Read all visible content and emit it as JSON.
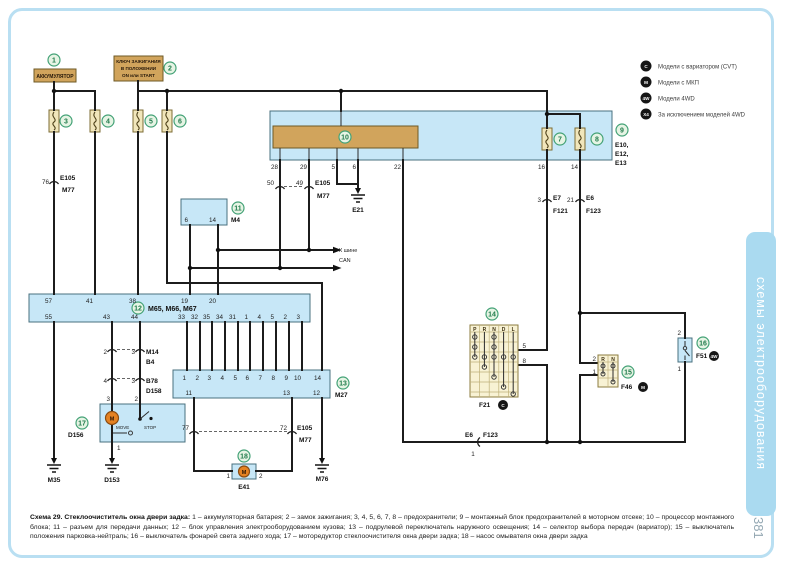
{
  "page": {
    "side_tab": "схемы электрооборудования",
    "number": "381"
  },
  "legend": {
    "items": [
      {
        "badge": "C",
        "text": "Модели с вариатором (CVT)"
      },
      {
        "badge": "M",
        "text": "Модели с МКП"
      },
      {
        "badge": "4W",
        "text": "Модели 4WD"
      },
      {
        "badge": "X4",
        "text": "За исключением моделей 4WD"
      }
    ]
  },
  "nums": {
    "n1": "1",
    "n2": "2",
    "n3": "3",
    "n4": "4",
    "n5": "5",
    "n6": "6",
    "n7": "7",
    "n8": "8",
    "n9": "9",
    "n10": "10",
    "n11": "11",
    "n12": "12",
    "n13": "13",
    "n14": "14",
    "n15": "15",
    "n16": "16",
    "n17": "17",
    "n18": "18"
  },
  "battery": {
    "label": "АККУМУЛЯТОР"
  },
  "ignition": {
    "l1": "КЛЮЧ ЗАЖИГАНИЯ",
    "l2": "В ПОЛОЖЕНИИ",
    "l3": "ON или START"
  },
  "box9": {
    "pins": [
      "28",
      "29",
      "5",
      "6",
      "22",
      "16",
      "14"
    ],
    "codes": [
      "E10,",
      "E12,",
      "E13"
    ]
  },
  "conn76": {
    "pin": "76",
    "a": "E105",
    "b": "M77"
  },
  "conn50": {
    "l": "50",
    "r": "49",
    "a": "E105",
    "b": "M77"
  },
  "connE7": {
    "pin": "3",
    "a": "E7",
    "b": "F121"
  },
  "connE6": {
    "pin": "21",
    "a": "E6",
    "b": "F123"
  },
  "grounds": {
    "e21": "E21",
    "m35": "M35",
    "d153": "D153",
    "m76": "M76"
  },
  "box11": {
    "label": "M4",
    "p1": "6",
    "p2": "14"
  },
  "can": {
    "l1": "К шине",
    "l2": "CAN"
  },
  "box12": {
    "label": "M65, M66, M67",
    "top": [
      "57",
      "41",
      "38",
      "19",
      "20"
    ],
    "bottom": [
      "55",
      "43",
      "44",
      "33",
      "32",
      "35",
      "34",
      "31",
      "1",
      "4",
      "5",
      "2",
      "3"
    ]
  },
  "connM14": {
    "l": "2",
    "r": "3",
    "a": "M14",
    "b": "B4"
  },
  "connB78": {
    "l": "4",
    "r": "3",
    "a": "B78",
    "b": "D158"
  },
  "box17": {
    "label": "D156",
    "p3": "3",
    "p2": "2",
    "p1": "1",
    "move": "MOVE",
    "stop": "STOP",
    "m": "M"
  },
  "box13": {
    "label": "M27",
    "top": [
      "1",
      "2",
      "3",
      "4",
      "5",
      "6",
      "7",
      "8",
      "9",
      "10",
      "14"
    ],
    "bottom": [
      "11",
      "13",
      "12"
    ]
  },
  "conn77": {
    "l": "77",
    "r": "72",
    "a": "E105",
    "b": "M77"
  },
  "motor18": {
    "label": "E41",
    "p1": "1",
    "p2": "2",
    "m": "M"
  },
  "sel": {
    "label": "F21",
    "badge": "C",
    "cols": [
      "P",
      "R",
      "N",
      "D",
      "L"
    ],
    "p5": "5",
    "p8": "8"
  },
  "f46": {
    "label": "F46",
    "badge": "M",
    "cols": [
      "R",
      "N"
    ],
    "p2": "2",
    "p1": "1"
  },
  "f51": {
    "label": "F51",
    "badge": "4W",
    "p2": "2",
    "p1": "1"
  },
  "connBottom": {
    "a": "E6",
    "b": "F123",
    "pin": "1"
  },
  "caption": {
    "title": "Схема 29. Стеклоочиститель окна двери задка:",
    "body": "1 – аккумуляторная батарея; 2 – замок зажигания; 3, 4, 5, 6, 7, 8 – предохранители; 9 – монтажный блок предохранителей в моторном отсеке; 10 – процессор монтажного блока; 11 – разъем для передачи данных; 12 – блок управления электрооборудованием кузова; 13 – подрулевой переключатель наружного освещения; 14 – селектор выбора передач (вариатор); 15 – выключатель положения парковка-нейтраль; 16 – выключатель фонарей света заднего хода; 17 – моторедуктор стеклоочистителя окна двери задка; 18 – насос омывателя окна двери задка"
  }
}
